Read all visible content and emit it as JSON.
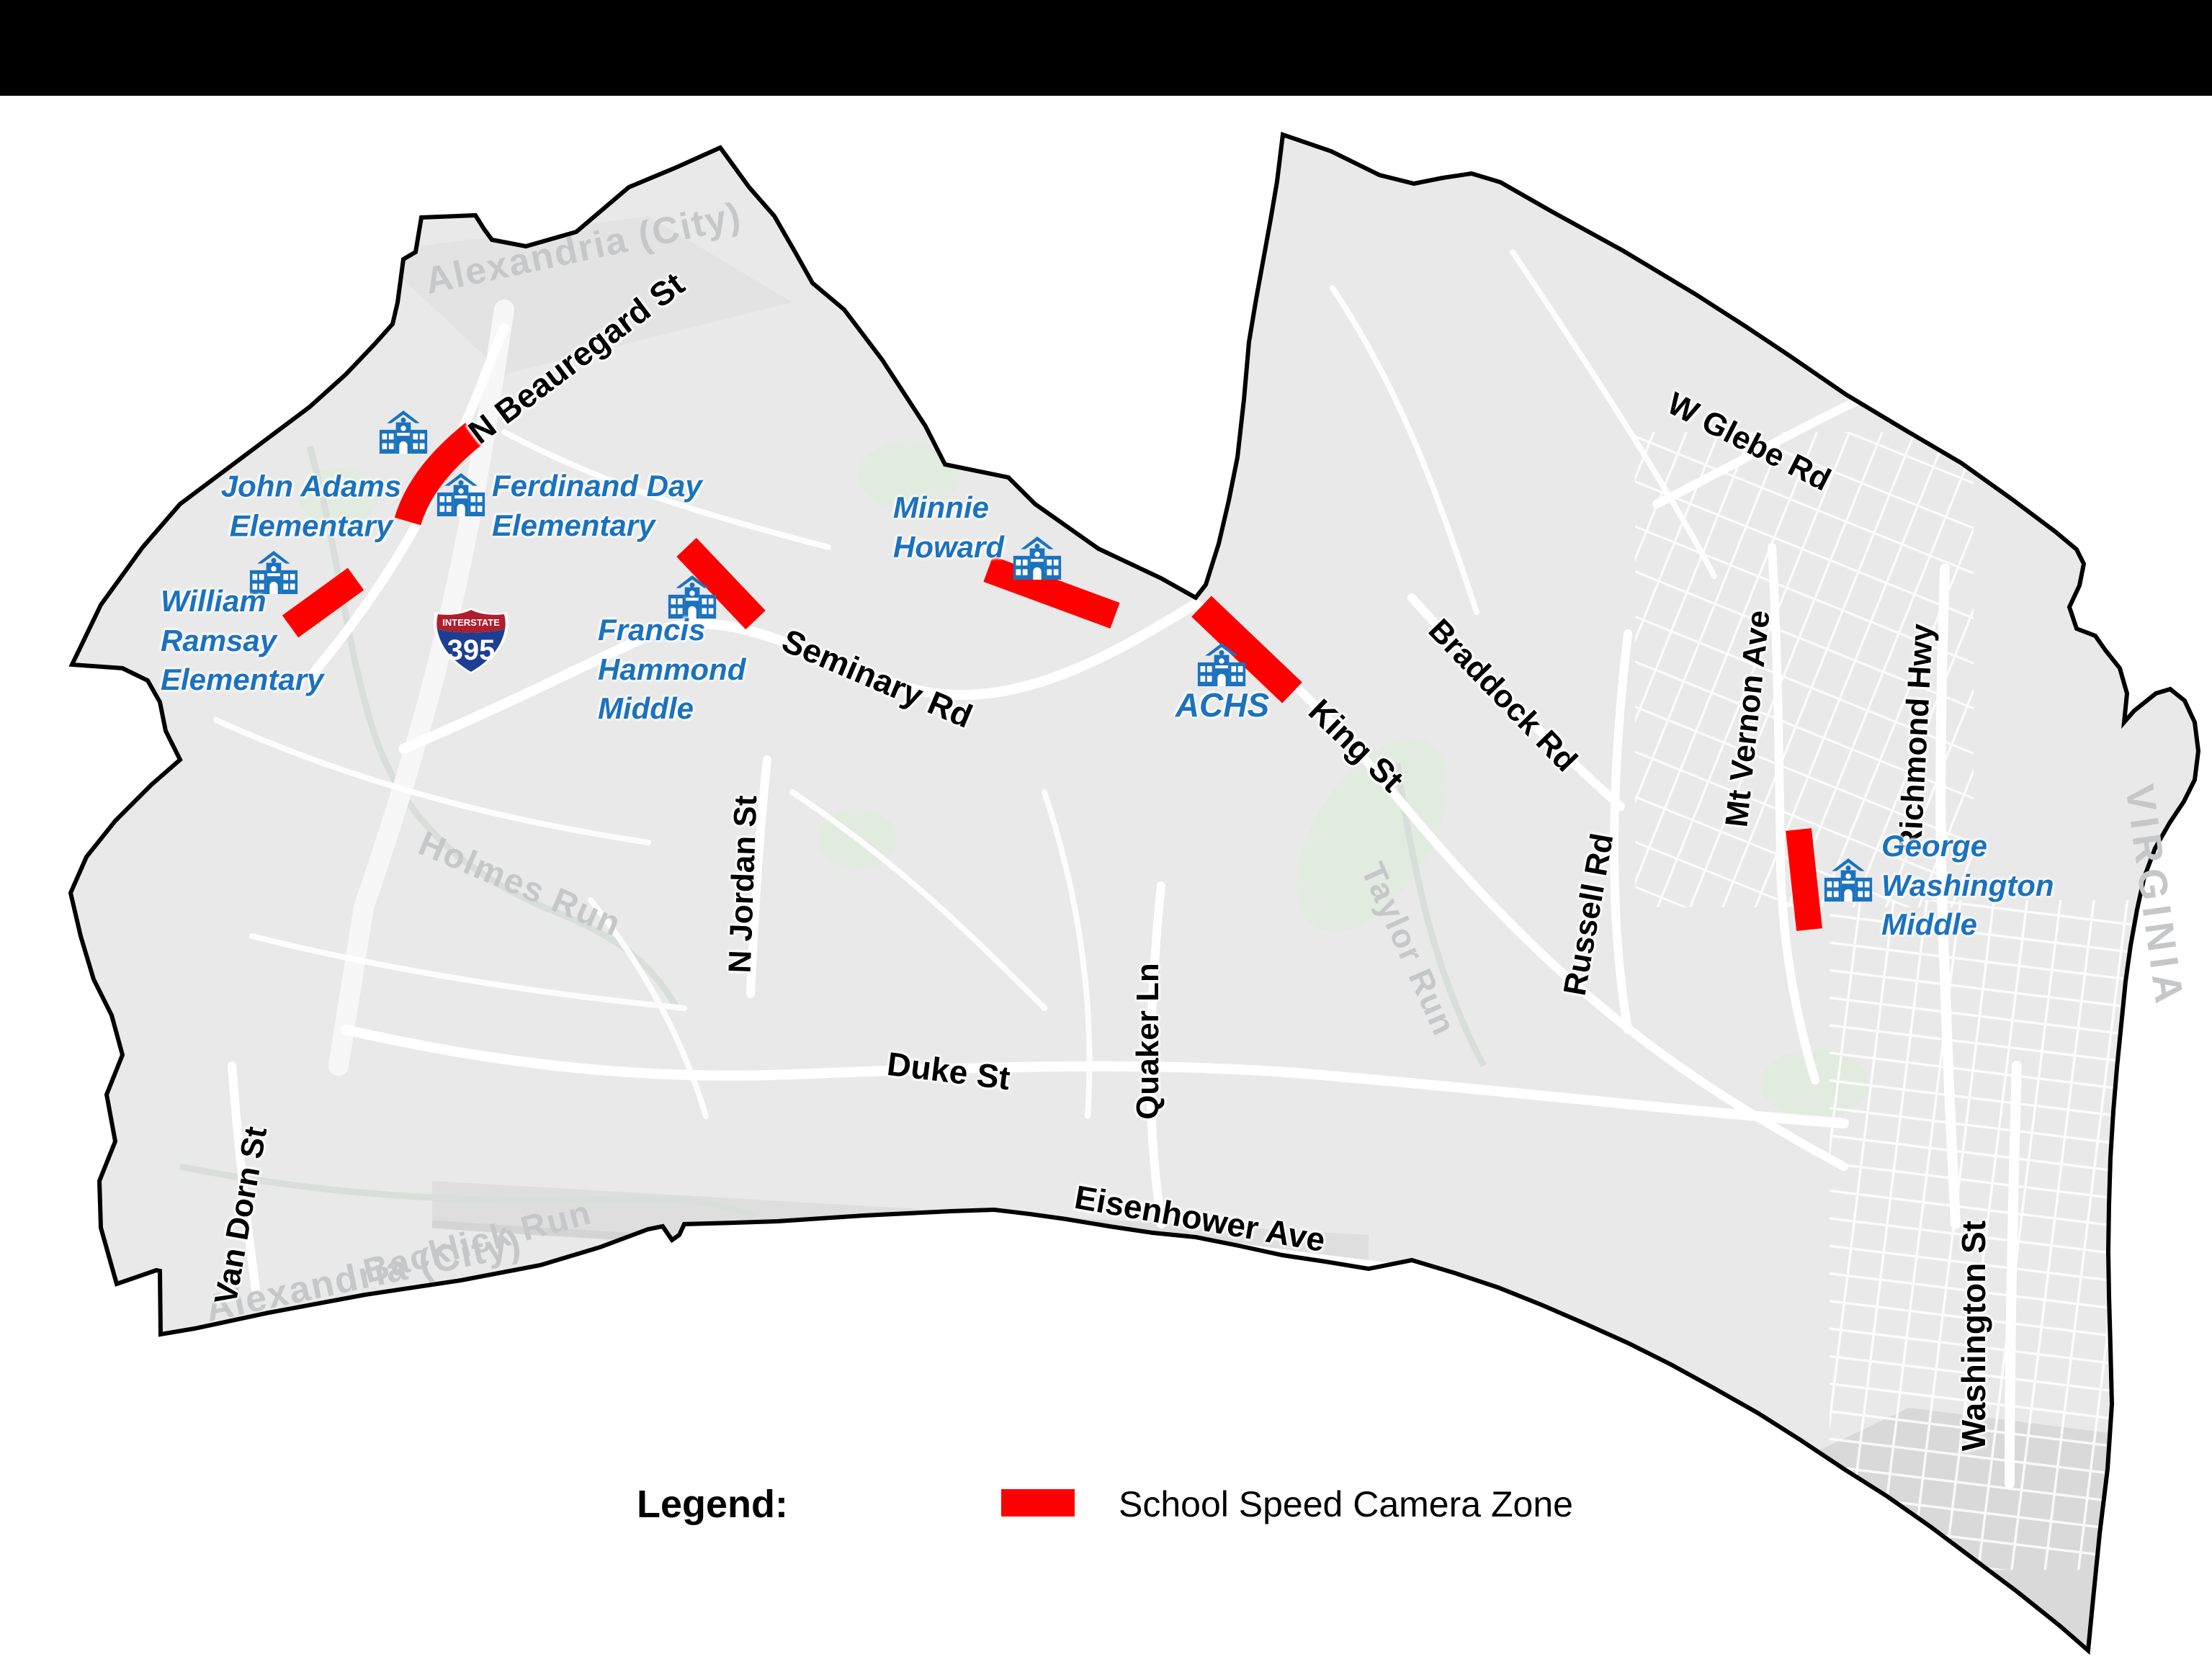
{
  "page": {
    "background": "#ffffff",
    "top_bar_color": "#000000"
  },
  "colors": {
    "land": "#E9E9E9",
    "boundary": "#000000",
    "road": "#ffffff",
    "camera_zone_red": "#FF0000",
    "school_blue": "#1B72BE",
    "muted_label_gray": "#C5C7C8",
    "shield_blue": "#1C3F94",
    "shield_red": "#AF1E2D"
  },
  "map": {
    "region_label_top": "Alexandria (City)",
    "region_label_bottom": "Alexandria (City)",
    "state_label": "VIRGINIA",
    "interstate_shield": {
      "top_text": "INTERSTATE",
      "number": "395"
    },
    "streets": {
      "n_beauregard": "N Beauregard St",
      "seminary": "Seminary Rd",
      "n_jordan": "N Jordan St",
      "duke": "Duke St",
      "van_dorn": "Van Dorn St",
      "quaker": "Quaker Ln",
      "king": "King St",
      "braddock": "Braddock Rd",
      "russell": "Russell Rd",
      "mt_vernon": "Mt Vernon Ave",
      "w_glebe": "W Glebe Rd",
      "richmond_hwy": "Richmond Hwy",
      "washington": "Washington St",
      "eisenhower": "Eisenhower Ave"
    },
    "waterways": {
      "holmes_run": "Holmes Run",
      "backlick_run": "Backlick Run",
      "taylor_run": "Taylor Run"
    },
    "schools": {
      "john_adams": {
        "label": "John Adams\nElementary"
      },
      "ferdinand_day": {
        "label": "Ferdinand Day\nElementary"
      },
      "william_ramsay": {
        "label": "William\nRamsay\nElementary"
      },
      "francis_hammond": {
        "label": "Francis\nHammond\nMiddle"
      },
      "minnie_howard": {
        "label": "Minnie\nHoward"
      },
      "achs": {
        "label": "ACHS"
      },
      "george_washington": {
        "label": "George\nWashington\nMiddle"
      }
    },
    "camera_zones": [
      "John Adams / N Beauregard St",
      "William Ramsay",
      "Francis Hammond / Seminary Rd",
      "Minnie Howard",
      "ACHS / King St",
      "George Washington Middle / Mt Vernon Ave"
    ]
  },
  "legend": {
    "title": "Legend:",
    "items": [
      {
        "label": "School Speed Camera Zone",
        "swatch_color": "#FF0000"
      }
    ]
  }
}
